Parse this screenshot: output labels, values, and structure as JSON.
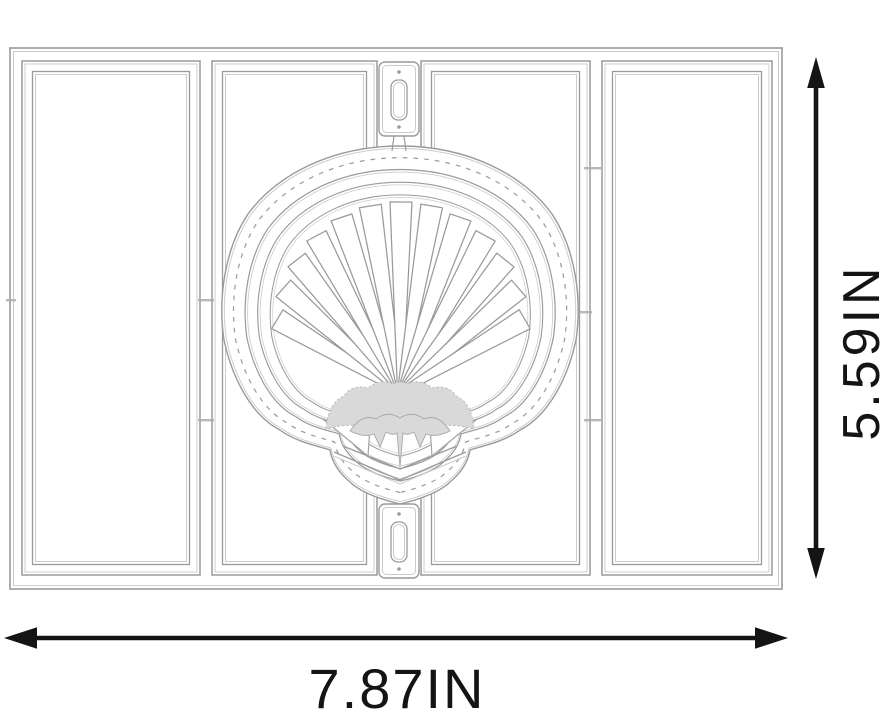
{
  "title": "Scallop seashell metal cutting die dimension diagram",
  "dimensions": {
    "width_label": "7.87IN",
    "height_label": "5.59IN"
  },
  "colors": {
    "background": "#ffffff",
    "die_line": "#9a9a9a",
    "die_line_light": "#cccccc",
    "hinge_fill": "#d9d9d9",
    "arrow": "#141414"
  },
  "die": {
    "motif": "scallop-shell",
    "panel_count": 4,
    "connector_tab_count": 2,
    "shell_ring_count": 4,
    "shell_rib_count": 13
  }
}
